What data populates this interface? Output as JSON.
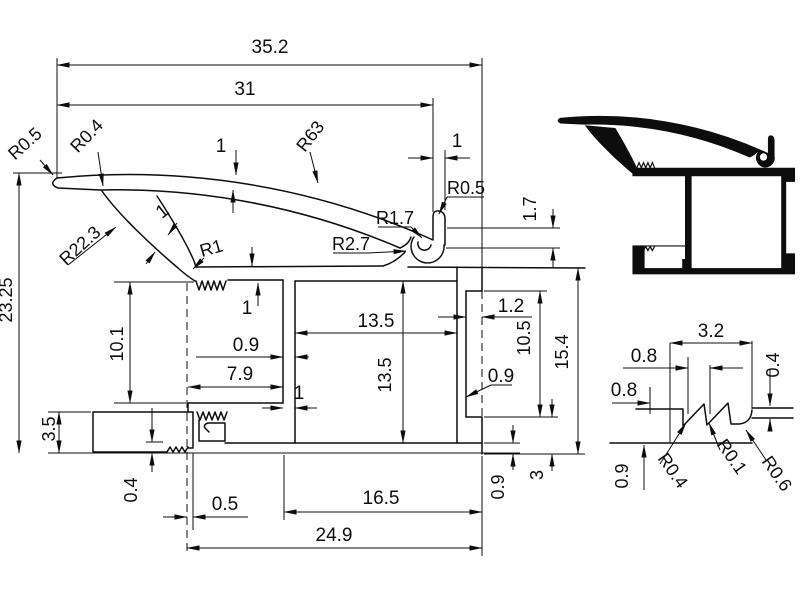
{
  "drawing": {
    "type": "engineering-cross-section",
    "colors": {
      "background": "#ffffff",
      "line": "#0d0d0d"
    }
  },
  "main": {
    "overall_width": "35.2",
    "upper_width": "31",
    "overall_height": "23.25",
    "bottom_width": "24.9",
    "inner_bottom_width": "16.5",
    "mid_cavity_width": "13.5",
    "mid_cavity_height": "13.5",
    "left_cavity_width": "7.9",
    "left_cavity_height": "10.1",
    "left_wall": "0.9",
    "divider_wall": "1",
    "top_wall": "1",
    "wing_thickness": "1",
    "leg_thickness": "1",
    "lip_thickness": "1",
    "foot_height": "3.5",
    "foot_tooth_depth": "0.4",
    "foot_offset": "0.5",
    "slot_height": "10.5",
    "right_height": "15.4",
    "slot_depth": "1.2",
    "mid_right_wall": "0.9",
    "bottom_lip": "3",
    "bottom_wall": "0.9",
    "hook_gap": "1.7",
    "r_tip": "R0.5",
    "r_tip_under": "R0.4",
    "r_wing": "R63",
    "r_leg": "R22.3",
    "r_leg_root": "R1",
    "r_hook_inner": "R1.7",
    "r_hook_outer": "R2.7",
    "r_lip": "R0.5"
  },
  "detail": {
    "width": "3.2",
    "tooth_pitch": "0.8",
    "tooth_offset": "0.8",
    "ledge_step": "0.4",
    "base_thickness": "0.9",
    "r_flank": "R0.4",
    "r_valley": "R0.1",
    "r_corner": "R0.6"
  }
}
